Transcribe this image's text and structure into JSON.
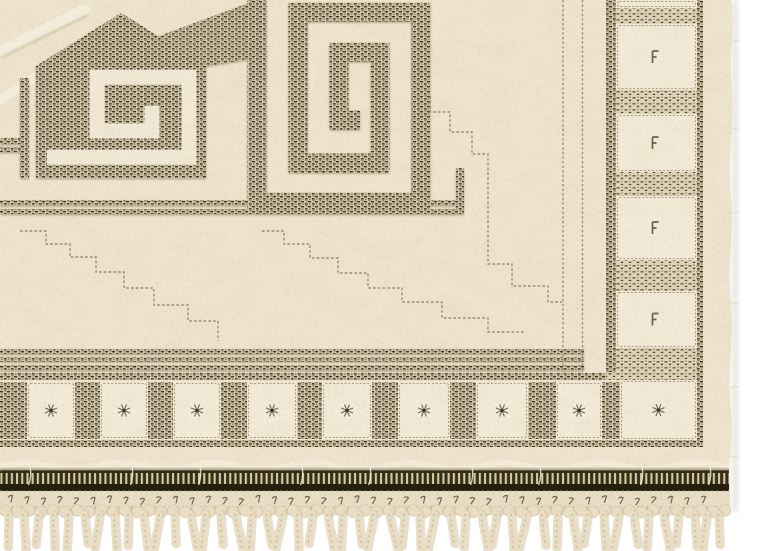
{
  "scene": {
    "type": "photograph",
    "subject": "corner detail of a cream wool pile rug with geometric relief pattern (Greek-key spiral and gabled motif), square-repeat woven border, dark striped selvedge band and knotted fringe on white background",
    "background_color": "#ffffff"
  },
  "colors": {
    "cream_base": "#efe5d0",
    "cream_bright": "#f6eedd",
    "square_fill": "#f3ebd8",
    "weave_tan": "#d5c8ab",
    "weave_dark": "#3a3222",
    "weave_mid": "#6d5f48",
    "stitch_line": "#84755c",
    "spiral_cream": "#f2e9d7",
    "ladder_dark": "#332d19",
    "ladder_light": "#dbcda2",
    "ladder_base": "#231f0e",
    "flat_band": "#eadfc8",
    "knot_fill": "#e9ddc4",
    "fringe_main": "#e9ddc3",
    "fringe_shadow": "#d3c5a8",
    "fringe_twist": "#cdbe9f",
    "edge_shadow": "#e3dfd6",
    "mark_dark": "#574a35",
    "mark_light": "#f8f1e2"
  },
  "geometry": {
    "canvas": {
      "w": 768,
      "h": 551
    },
    "rug_right_edge_x": 733,
    "right_border": {
      "guard_line_x1": 563,
      "guard_line_x2": 582.5,
      "inner_line_x": 606,
      "inner_line_w": 10,
      "outer_line_x": 697,
      "outer_line_w": 6,
      "squares_x": 616,
      "squares_w": 81,
      "square_ys": [
        [
          0,
          8
        ],
        [
          24,
          66
        ],
        [
          114,
          58
        ],
        [
          196,
          64
        ],
        [
          291,
          57
        ]
      ],
      "gap_ys": [
        [
          8,
          16
        ],
        [
          90,
          24
        ],
        [
          172,
          24
        ],
        [
          260,
          31
        ],
        [
          348,
          25
        ]
      ]
    },
    "bottom_border": {
      "top_line_y": 373,
      "top_line_h": 7,
      "squares_y": 382,
      "squares_h": 57,
      "bottom_line_y": 440,
      "bottom_line_h": 7,
      "square_xs": [
        [
          27,
          48
        ],
        [
          100,
          48
        ],
        [
          173,
          48
        ],
        [
          247,
          50
        ],
        [
          322,
          50
        ],
        [
          398,
          52
        ],
        [
          476,
          52
        ],
        [
          556,
          46
        ]
      ],
      "corner_square": [
        620,
        380,
        77,
        60
      ]
    },
    "ladder_band": {
      "y": 471,
      "h": 20,
      "right_x": 729
    },
    "flat_band": {
      "y": 492,
      "h": 23
    },
    "stitch_row": {
      "y": 498,
      "start_x": 8,
      "spacing": 16.5,
      "count": 43
    },
    "knot_row": {
      "y": 510.5,
      "start_x": 5,
      "spacing": 12,
      "count": 61
    },
    "fringe": {
      "top_y": 514,
      "strand_width": 7,
      "strands": [
        {
          "x": 8,
          "lean": -1,
          "len": 33
        },
        {
          "x": 23,
          "lean": 2,
          "len": 36
        },
        {
          "x": 38,
          "lean": -3,
          "len": 31
        },
        {
          "x": 53,
          "lean": 1,
          "len": 35
        },
        {
          "x": 68,
          "lean": -2,
          "len": 37
        },
        {
          "x": 84,
          "lean": 3,
          "len": 30
        },
        {
          "x": 99,
          "lean": -5,
          "len": 34
        },
        {
          "x": 114,
          "lean": 2,
          "len": 36
        },
        {
          "x": 128,
          "lean": -1,
          "len": 32
        },
        {
          "x": 143,
          "lean": 4,
          "len": 35
        },
        {
          "x": 159,
          "lean": -6,
          "len": 37
        },
        {
          "x": 174,
          "lean": 1,
          "len": 30
        },
        {
          "x": 190,
          "lean": 6,
          "len": 34
        },
        {
          "x": 205,
          "lean": -4,
          "len": 36
        },
        {
          "x": 220,
          "lean": 2,
          "len": 31
        },
        {
          "x": 235,
          "lean": 7,
          "len": 35
        },
        {
          "x": 251,
          "lean": -2,
          "len": 37
        },
        {
          "x": 266,
          "lean": 5,
          "len": 32
        },
        {
          "x": 282,
          "lean": -7,
          "len": 34
        },
        {
          "x": 297,
          "lean": 1,
          "len": 36
        },
        {
          "x": 312,
          "lean": -4,
          "len": 30
        },
        {
          "x": 327,
          "lean": 6,
          "len": 35
        },
        {
          "x": 342,
          "lean": -2,
          "len": 37
        },
        {
          "x": 358,
          "lean": 3,
          "len": 31
        },
        {
          "x": 373,
          "lean": -6,
          "len": 34
        },
        {
          "x": 389,
          "lean": 8,
          "len": 36
        },
        {
          "x": 404,
          "lean": -3,
          "len": 32
        },
        {
          "x": 419,
          "lean": 1,
          "len": 35
        },
        {
          "x": 434,
          "lean": -7,
          "len": 37
        },
        {
          "x": 450,
          "lean": 4,
          "len": 30
        },
        {
          "x": 465,
          "lean": -2,
          "len": 34
        },
        {
          "x": 481,
          "lean": 6,
          "len": 36
        },
        {
          "x": 496,
          "lean": -5,
          "len": 31
        },
        {
          "x": 511,
          "lean": 2,
          "len": 35
        },
        {
          "x": 526,
          "lean": -8,
          "len": 37
        },
        {
          "x": 542,
          "lean": 3,
          "len": 32
        },
        {
          "x": 557,
          "lean": -1,
          "len": 34
        },
        {
          "x": 572,
          "lean": 5,
          "len": 36
        },
        {
          "x": 587,
          "lean": -4,
          "len": 30
        },
        {
          "x": 603,
          "lean": 2,
          "len": 35
        },
        {
          "x": 618,
          "lean": -6,
          "len": 37
        },
        {
          "x": 633,
          "lean": 4,
          "len": 31
        },
        {
          "x": 648,
          "lean": -2,
          "len": 34
        },
        {
          "x": 663,
          "lean": 6,
          "len": 36
        },
        {
          "x": 678,
          "lean": -3,
          "len": 30
        },
        {
          "x": 694,
          "lean": 2,
          "len": 33
        },
        {
          "x": 706,
          "lean": -4,
          "len": 35
        },
        {
          "x": 718,
          "lean": 1,
          "len": 31
        }
      ]
    }
  }
}
